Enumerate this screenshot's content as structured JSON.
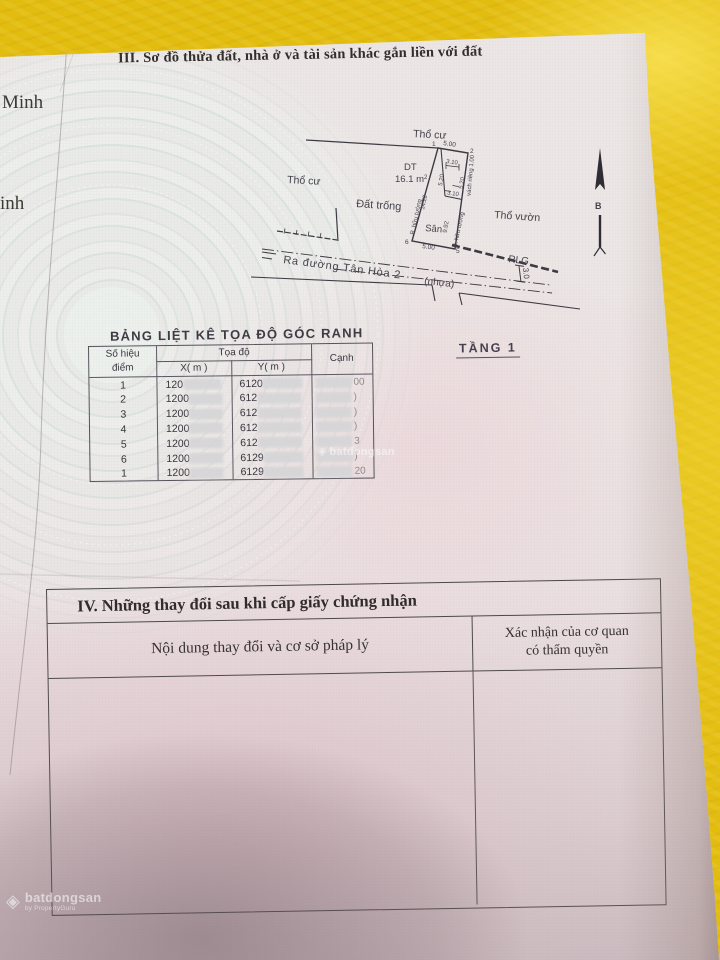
{
  "photo": {
    "background_color": "#e2bc0f",
    "paper_color": "#ece7e6"
  },
  "margin_texts": {
    "left_top": "Minh",
    "left_mid": "inh"
  },
  "section3": {
    "title": "III. Sơ đồ thửa đất, nhà ở và tài sản khác gắn liền với đất"
  },
  "diagram": {
    "labels": {
      "tho_cu_top": "Thổ cư",
      "tho_cu_left": "Thổ cư",
      "dat_trong": "Đất trống",
      "tho_vuon": "Thổ vườn",
      "dt": "DT",
      "dt_area": "16.1 m",
      "dt_area_sup": "2",
      "san": "Sân",
      "road_name": "Ra đường Tân Hòa 2",
      "road_surface": "(nhựa)",
      "rlg": "RLG",
      "rlg_width": "3.0",
      "north": "B"
    },
    "points": {
      "p1": "1",
      "p2": "2",
      "p5": "5",
      "p6": "6"
    },
    "dims": {
      "top": "5.00",
      "bottom": "5.00",
      "house_w_top": "3.10",
      "house_w_bottom": "3.10",
      "house_h_left": "5.20",
      "house_h_right": "5.20",
      "side_left": "14.22",
      "side_right": "9.92",
      "wall_left": "R. hữu tường",
      "wall_right": "R. hữu tường",
      "wall_private": "vách riêng 1.00"
    },
    "floor_label": "TẦNG 1"
  },
  "coord_table": {
    "title": "BẢNG LIỆT KÊ TỌA ĐỘ GÓC RANH",
    "headers": {
      "point_1": "Số hiệu",
      "point_2": "điểm",
      "coords": "Tọa độ",
      "x": "X( m )",
      "y": "Y( m )",
      "edge": "Cạnh"
    },
    "rows": [
      {
        "diem": "1",
        "x": "120",
        "y": "6120",
        "canh": "00"
      },
      {
        "diem": "2",
        "x": "1200",
        "y": "612",
        "canh": ")"
      },
      {
        "diem": "3",
        "x": "1200",
        "y": "612",
        "canh": ")"
      },
      {
        "diem": "4",
        "x": "1200",
        "y": "612",
        "canh": ")"
      },
      {
        "diem": "5",
        "x": "1200",
        "y": "612",
        "canh": "3"
      },
      {
        "diem": "6",
        "x": "1200",
        "y": "6129",
        "canh": ")"
      },
      {
        "diem": "1",
        "x": "1200",
        "y": "6129",
        "canh": "20"
      }
    ]
  },
  "section4": {
    "title": "IV. Những thay đổi sau khi cấp giấy chứng nhận",
    "col_content": "Nội dung thay đổi và cơ sở pháp lý",
    "col_confirm_1": "Xác nhận của cơ quan",
    "col_confirm_2": "có thẩm quyền"
  },
  "watermarks": {
    "brand": "batdongsan",
    "brand_sub": "by PropertyGuru",
    "table_brand": "batdongsan",
    "logo_glyph": "◈"
  }
}
